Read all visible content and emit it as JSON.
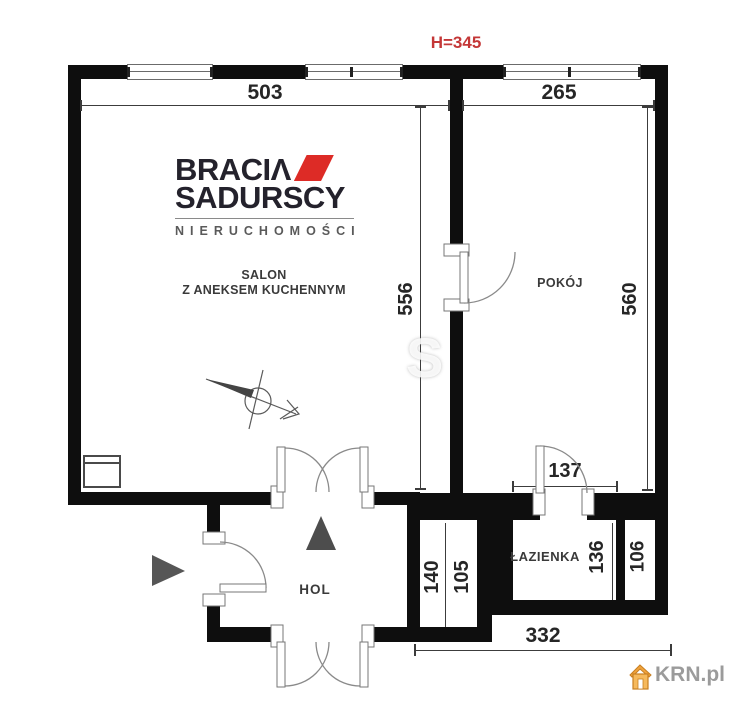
{
  "plan": {
    "height_label": "H=345",
    "rooms": {
      "salon_line1": "SALON",
      "salon_line2": "Z ANEKSEM KUCHENNYM",
      "pokoj": "POKÓJ",
      "lazienka": "ŁAZIENKA",
      "hol": "HOL"
    },
    "dimensions": {
      "salon_width": "503",
      "pokoj_width": "265",
      "salon_depth": "556",
      "pokoj_depth": "560",
      "bath_width": "137",
      "niche_left": "140",
      "niche_mid": "105",
      "bath_depth": "136",
      "shaft": "106",
      "bottom_width": "332"
    },
    "colors": {
      "wall": "#0e0e0e",
      "height_label_red": "#c43737",
      "dimension_text": "#262626"
    }
  },
  "branding": {
    "logo_line1": "BRACIΛ",
    "logo_line2": "SADURSCY",
    "logo_line3": "NIERUCHOMOŚCI",
    "logo_red": "#dd2b26",
    "logo_text_color": "#24222c",
    "watermark_letter": "S",
    "portal": "KRN.pl",
    "portal_text_color": "#9b9b9b",
    "portal_house_color": "#f1a33c"
  }
}
